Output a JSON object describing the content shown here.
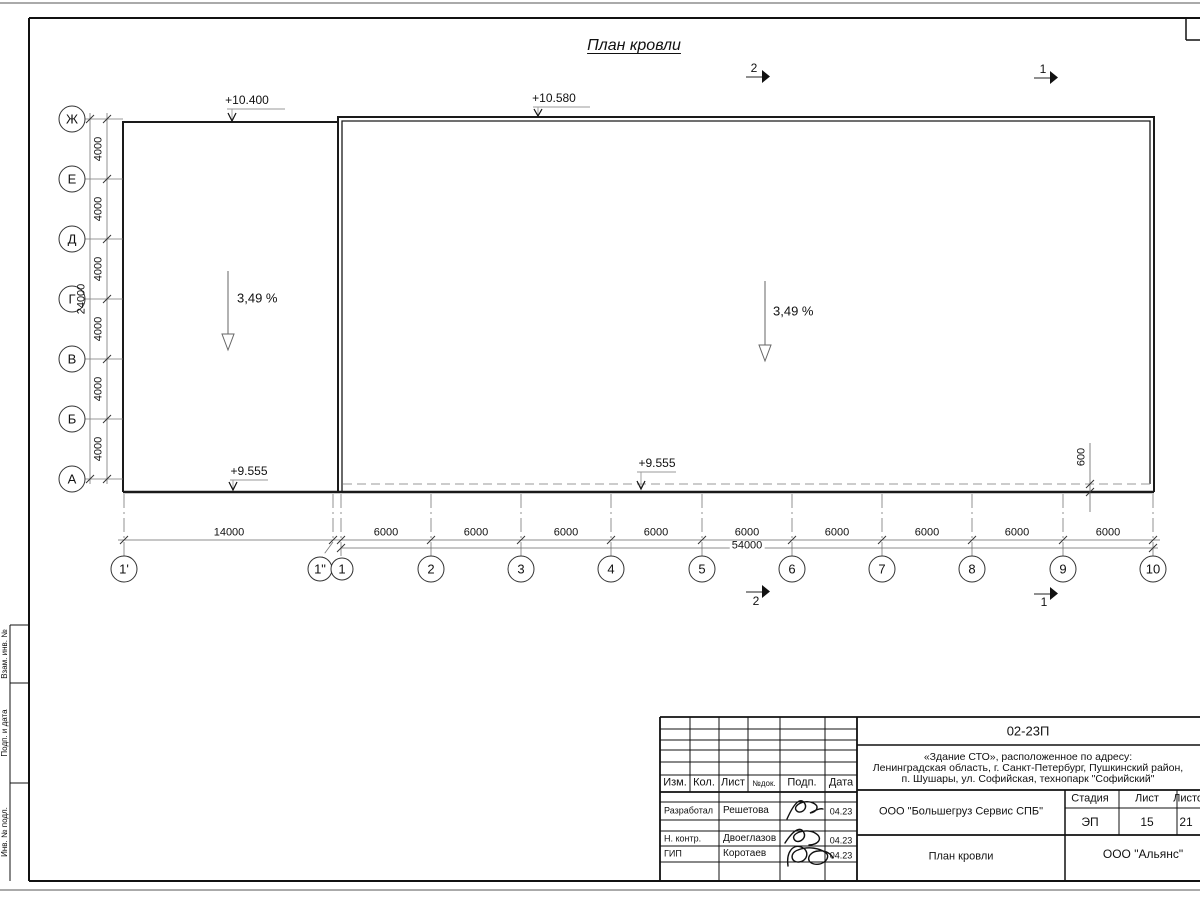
{
  "sheet": {
    "title": "План кровли",
    "axes_left": [
      "Ж",
      "Е",
      "Д",
      "Г",
      "В",
      "Б",
      "А"
    ],
    "axes_bottom": [
      "1'",
      "1\"",
      "1",
      "2",
      "3",
      "4",
      "5",
      "6",
      "7",
      "8",
      "9",
      "10"
    ],
    "dims": {
      "left_segment": "4000",
      "left_total": "24000",
      "bottom_first_bay": "14000",
      "bottom_bay": "6000",
      "bottom_total": "54000",
      "edge_offset": "600"
    },
    "elevations": {
      "top_left": "+10.400",
      "top_mid": "+10.580",
      "bottom_left": "+9.555",
      "bottom_mid": "+9.555"
    },
    "slopes": {
      "left": "3,49 %",
      "right": "3,49 %"
    },
    "sections": {
      "top_2": "2",
      "top_1": "1",
      "bottom_2": "2",
      "bottom_1": "1"
    },
    "margin_labels": [
      "Взам. инв. №",
      "Подп. и дата",
      "Инв. № подл."
    ]
  },
  "titleblock": {
    "code": "02-23П",
    "address": [
      "«Здание СТО», расположенное по адресу:",
      "Ленинградская область, г. Санкт-Петербург, Пушкинский район,",
      "п. Шушары, ул. Софийская, технопарк \"Софийский\""
    ],
    "columns": [
      "Изм.",
      "Кол.",
      "Лист",
      "№док.",
      "Подп.",
      "Дата"
    ],
    "rows": [
      {
        "role": "Разработал",
        "name": "Решетова",
        "date": "04.23"
      },
      {
        "role": "Н. контр.",
        "name": "Двоеглазов",
        "date": "04.23"
      },
      {
        "role": "ГИП",
        "name": "Коротаев",
        "date": "04.23"
      }
    ],
    "client": "ООО \"Большегруз Сервис СПБ\"",
    "stage_label": "Стадия",
    "sheet_label": "Лист",
    "sheets_label": "Листов",
    "stage": "ЭП",
    "sheet_no": "15",
    "sheets_total": "21",
    "drawing_name": "План кровли",
    "org": "ООО \"Альянс\""
  }
}
